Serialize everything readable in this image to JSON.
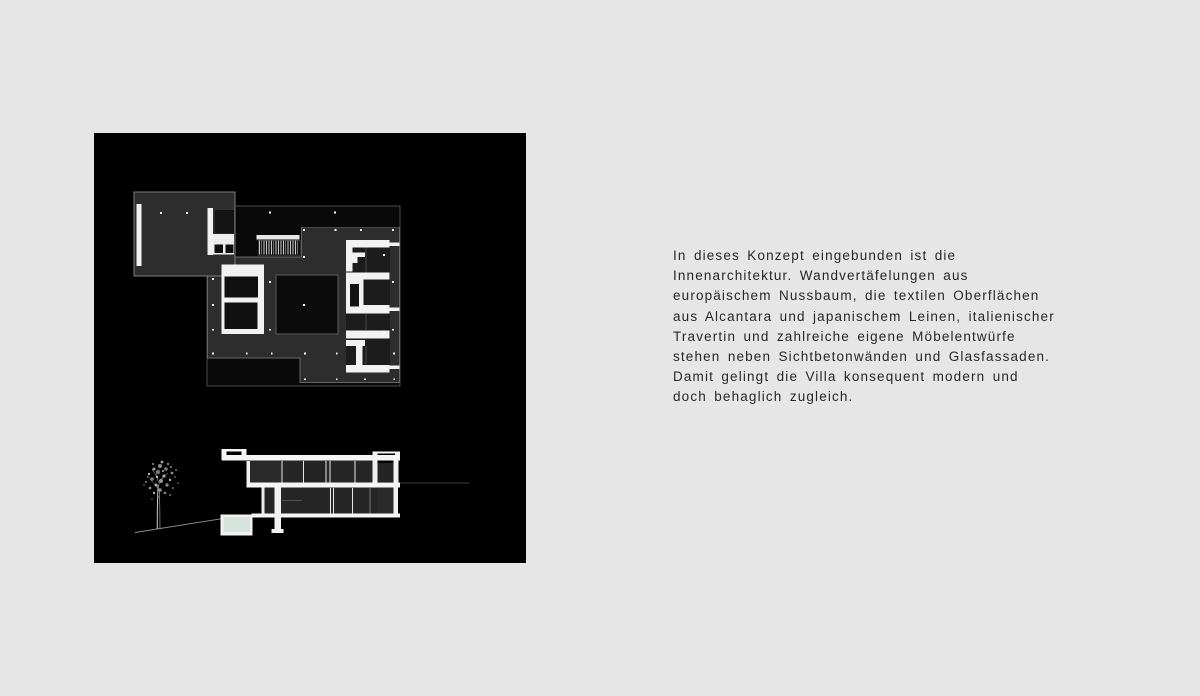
{
  "page": {
    "background_color": "#e6e6e6"
  },
  "image_panel": {
    "background_color": "#000000",
    "drawing_colors": {
      "plan_fill": "#2d2d2d",
      "wall_white": "#f2f2f2",
      "pool_water": "#d5e3dc"
    }
  },
  "description": {
    "lines": [
      "In dieses Konzept eingebunden ist die",
      "Innenarchitektur. Wandvertäfelungen aus",
      "europäischem Nussbaum, die textilen Oberflächen",
      "aus Alcantara und japanischem Leinen, italienischer",
      "Travertin und zahlreiche eigene Möbelentwürfe",
      "stehen neben Sichtbetonwänden und Glasfassaden.",
      "Damit gelingt die Villa konsequent modern und",
      "doch behaglich zugleich."
    ]
  }
}
